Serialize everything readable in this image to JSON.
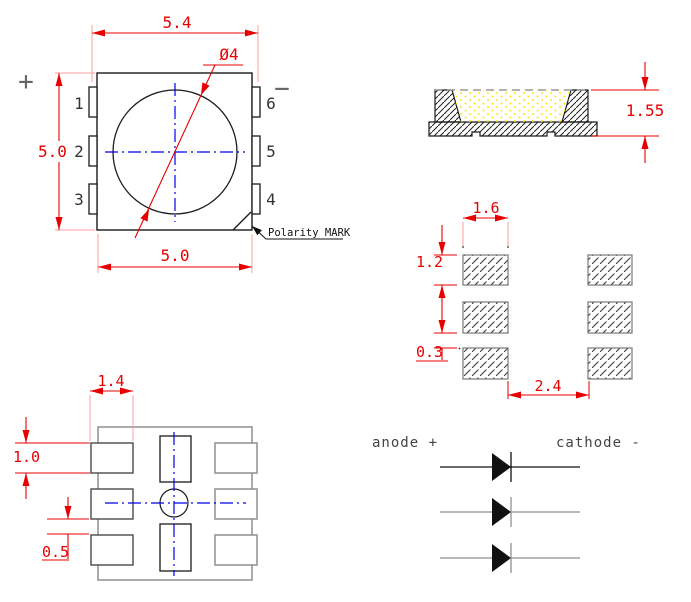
{
  "top_view": {
    "dim_overall_width": "5.4",
    "dim_body_height": "5.0",
    "dim_body_width": "5.0",
    "dim_lens_diameter": "Ø4",
    "polarity_mark_label": "Polarity MARK",
    "plus_sign": "+",
    "minus_sign": "−",
    "pin_numbers": [
      "1",
      "2",
      "3",
      "6",
      "5",
      "4"
    ]
  },
  "side_view": {
    "dim_height": "1.55"
  },
  "pad_layout": {
    "dim_pad_width": "1.6",
    "dim_pad_height": "1.2",
    "dim_row_gap": "0.3",
    "dim_column_gap": "2.4"
  },
  "bottom_view": {
    "dim_pad_width": "1.4",
    "dim_pad_height": "1.0",
    "dim_row_gap": "0.5"
  },
  "polarity_diagram": {
    "anode_label": "anode +",
    "cathode_label": "cathode -"
  },
  "colors": {
    "dimension_red": "#e80000",
    "extension_pink": "#ff9d9d",
    "centerline_blue": "#0000e8",
    "outline_black": "#1a1a1a",
    "outline_gray": "#8f8f8f",
    "phosphor_yellow": "#ffe813"
  }
}
